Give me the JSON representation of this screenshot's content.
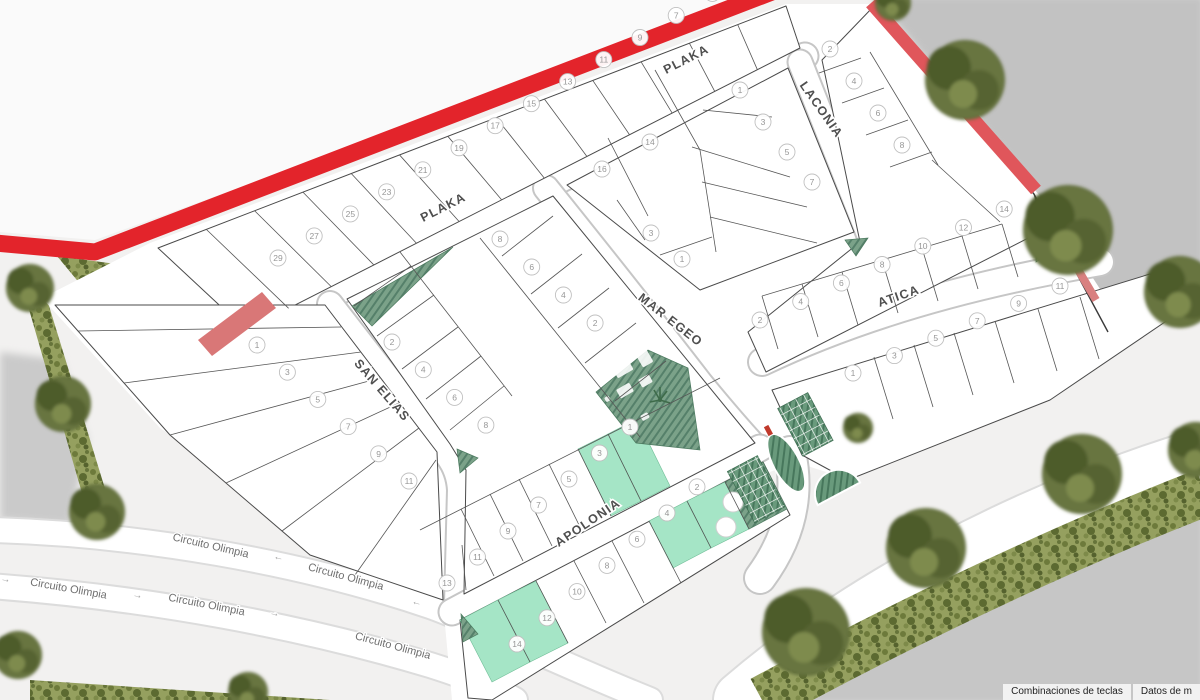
{
  "map": {
    "streets": [
      {
        "label": "PLAKA"
      },
      {
        "label": "PLAKA"
      },
      {
        "label": "LACONIA"
      },
      {
        "label": "MAR EGEO"
      },
      {
        "label": "ATICA"
      },
      {
        "label": "SAN ELIAS"
      },
      {
        "label": "APOLONIA"
      }
    ],
    "outer_roads": [
      {
        "label": "Circuito Olimpia"
      },
      {
        "label": "←"
      },
      {
        "label": "Circuito Olimpia"
      },
      {
        "label": "←"
      },
      {
        "label": "→"
      },
      {
        "label": "Circuito Olimpia"
      },
      {
        "label": "→"
      },
      {
        "label": "Circuito Olimpia"
      },
      {
        "label": "→"
      },
      {
        "label": "Circuito Olimpia"
      }
    ],
    "blocks": [
      {
        "id": "plaka-north",
        "lots": [
          {
            "n": "29"
          },
          {
            "n": "27"
          },
          {
            "n": "25"
          },
          {
            "n": "23"
          },
          {
            "n": "21"
          },
          {
            "n": "19"
          },
          {
            "n": "17"
          },
          {
            "n": "15"
          },
          {
            "n": "13"
          },
          {
            "n": "11"
          },
          {
            "n": "9"
          },
          {
            "n": "7"
          },
          {
            "n": "5"
          }
        ]
      },
      {
        "id": "plaka-laconia",
        "lots": [
          {
            "n": "16"
          },
          {
            "n": "14"
          },
          {
            "n": "1"
          },
          {
            "n": "3"
          },
          {
            "n": "5"
          },
          {
            "n": "7"
          },
          {
            "n": "3"
          },
          {
            "n": "1"
          }
        ]
      },
      {
        "id": "laconia-east",
        "lots": [
          {
            "n": "2"
          },
          {
            "n": "4"
          },
          {
            "n": "6"
          },
          {
            "n": "8"
          }
        ]
      },
      {
        "id": "atica-north",
        "lots": [
          {
            "n": "2"
          },
          {
            "n": "4"
          },
          {
            "n": "6"
          },
          {
            "n": "8"
          },
          {
            "n": "10"
          },
          {
            "n": "12"
          },
          {
            "n": "14"
          }
        ]
      },
      {
        "id": "atica-south",
        "lots": [
          {
            "n": "1"
          },
          {
            "n": "3"
          },
          {
            "n": "5"
          },
          {
            "n": "7"
          },
          {
            "n": "9"
          },
          {
            "n": "11"
          }
        ]
      },
      {
        "id": "central",
        "lots": [
          {
            "n": "2"
          },
          {
            "n": "4"
          },
          {
            "n": "6"
          },
          {
            "n": "8"
          },
          {
            "n": "8"
          },
          {
            "n": "6"
          },
          {
            "n": "4"
          },
          {
            "n": "2"
          },
          {
            "n": "1",
            "status": "available"
          },
          {
            "n": "3",
            "status": "available"
          },
          {
            "n": "5"
          },
          {
            "n": "7"
          },
          {
            "n": "9"
          },
          {
            "n": "11"
          },
          {
            "n": "13"
          }
        ]
      },
      {
        "id": "san-elias-west",
        "lots": [
          {
            "n": "1"
          },
          {
            "n": "3"
          },
          {
            "n": "5"
          },
          {
            "n": "7"
          },
          {
            "n": "9"
          },
          {
            "n": "11"
          }
        ]
      },
      {
        "id": "apolonia-south",
        "lots": [
          {
            "n": "14",
            "status": "available"
          },
          {
            "n": "12",
            "status": "available"
          },
          {
            "n": "10"
          },
          {
            "n": "8"
          },
          {
            "n": "6"
          },
          {
            "n": "4",
            "status": "available"
          },
          {
            "n": "2",
            "status": "available"
          }
        ]
      }
    ],
    "colors": {
      "highlight_road": "#e3242b",
      "available_lot": "#a5e5c6",
      "green_area": "#7ba289",
      "road": "#ffffff",
      "street_label": "#4f4f4f"
    }
  },
  "footer": {
    "keyboard_shortcuts": "Combinaciones de teclas",
    "map_data": "Datos de m"
  }
}
